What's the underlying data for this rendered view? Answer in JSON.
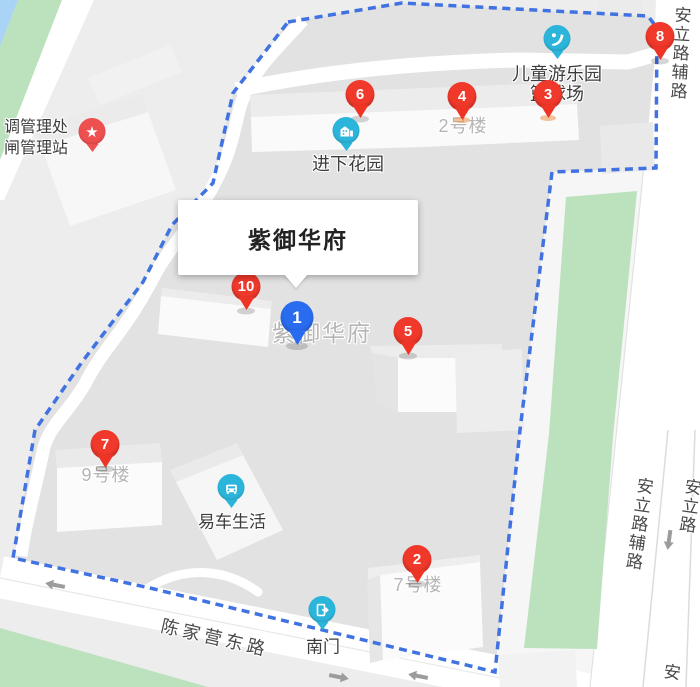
{
  "info_card": {
    "title": "紫御华府"
  },
  "markers": [
    {
      "label": "1",
      "type": "blue"
    },
    {
      "label": "2",
      "type": "red"
    },
    {
      "label": "3",
      "type": "red"
    },
    {
      "label": "4",
      "type": "red"
    },
    {
      "label": "5",
      "type": "red"
    },
    {
      "label": "6",
      "type": "red"
    },
    {
      "label": "7",
      "type": "red"
    },
    {
      "label": "8",
      "type": "red"
    },
    {
      "label": "10",
      "type": "red"
    }
  ],
  "pois": [
    {
      "icon": "slide-icon",
      "lines": [
        "儿童游乐园",
        "篮球场"
      ]
    },
    {
      "icon": "house-icon",
      "lines": [
        "进下花园"
      ]
    },
    {
      "icon": "car-icon",
      "lines": [
        "易车生活"
      ]
    },
    {
      "icon": "gate-icon",
      "lines": [
        "南门"
      ]
    },
    {
      "icon": "star-icon",
      "lines": [
        "调管理处",
        "闸管理站"
      ]
    }
  ],
  "building_labels": [
    {
      "text": "2号楼"
    },
    {
      "text": "9号楼"
    },
    {
      "text": "7号楼"
    },
    {
      "text": "紫御华府"
    }
  ],
  "road_labels": [
    {
      "text": "陈家营东路"
    },
    {
      "text": "安立路辅路"
    },
    {
      "text": "安立路辅路"
    },
    {
      "text": "安立路"
    },
    {
      "text": "安"
    }
  ],
  "colors": {
    "marker_red": "#f0392b",
    "marker_blue": "#2a6cef",
    "poi_teal": "#2cb5da",
    "star_red": "#ee4f4f",
    "boundary_blue": "#4072e2",
    "green_area": "#bbe1bd",
    "water": "#a9d4f5",
    "road_white": "#ffffff",
    "compound_gray": "#e2e2e2"
  }
}
